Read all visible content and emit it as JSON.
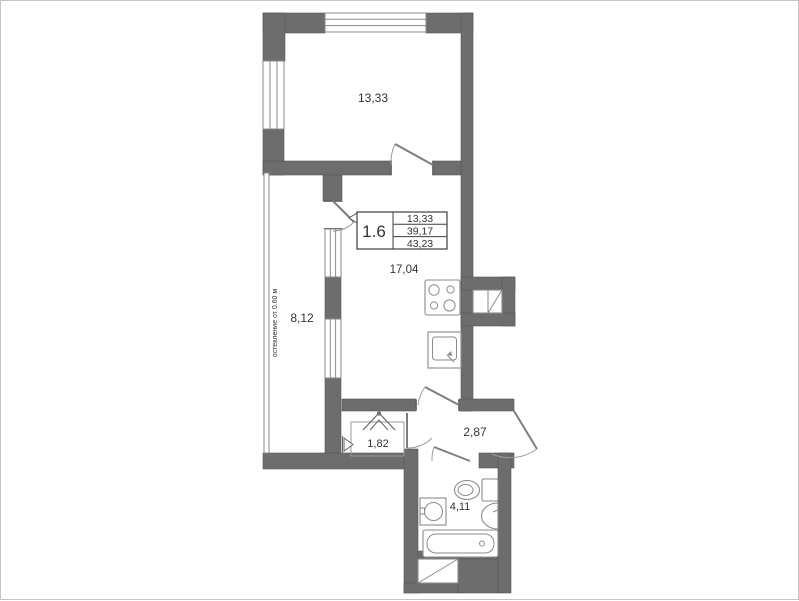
{
  "plan": {
    "title": "apartment-floor-plan",
    "rooms": {
      "room_top": "13,33",
      "living_kitchen": "17,04",
      "balcony": "8,12",
      "wardrobe": "1,82",
      "hall": "2,87",
      "bathroom": "4,11"
    },
    "info_box": {
      "unit": "1.6",
      "rows": [
        "13,33",
        "39,17",
        "43,23"
      ]
    },
    "annotation_glazing": "остекление от 0.60 м",
    "icons": {
      "stove": "four-burner-cooktop",
      "kitchen_sink": "square-sink-with-tap",
      "vent_shaft": "square-with-diagonal",
      "hatch_shaft": "square-with-diagonal",
      "toilet": "toilet-with-tank",
      "bath_sink": "round-basin-in-square",
      "washbasin": "half-oval-wall-basin",
      "bathtub": "bathtub",
      "hanger": "coat-hanger-chevrons",
      "doors": "quarter-arc-swing"
    },
    "colors": {
      "wall": "#6d6d6d",
      "wall_stroke": "#595959",
      "line": "#8a8a8a",
      "text": "#333333",
      "background": "#ffffff"
    }
  }
}
